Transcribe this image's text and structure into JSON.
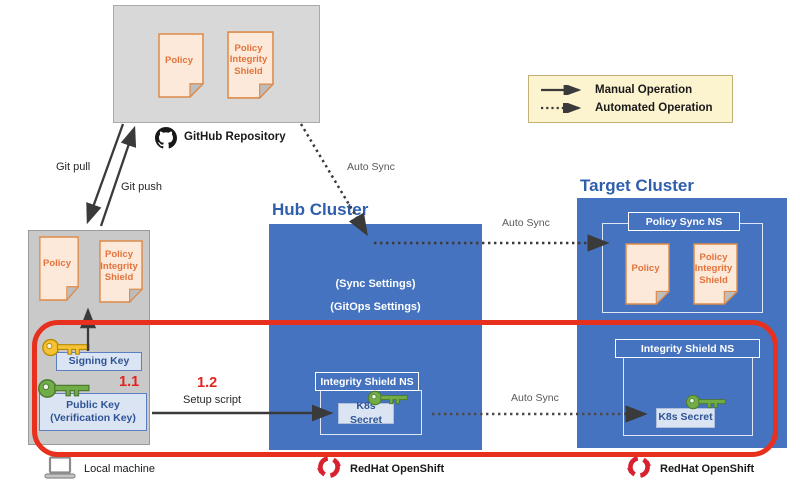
{
  "legend": {
    "manual_label": "Manual Operation",
    "automated_label": "Automated Operation"
  },
  "github_repo": {
    "caption": "GitHub Repository",
    "policy_doc": "Policy",
    "integrity_shield_doc": "Policy Integrity Shield"
  },
  "local_machine": {
    "policy_doc": "Policy",
    "integrity_shield_doc": "Policy Integrity Shield",
    "signing_key": "Signing Key",
    "public_key_line1": "Public Key",
    "public_key_line2": "(Verification Key)",
    "caption": "Local machine"
  },
  "hub_cluster": {
    "title": "Hub Cluster",
    "sync_settings": "(Sync Settings)",
    "gitops_settings": "(GitOps Settings)",
    "namespace": "Integrity Shield NS",
    "secret": "K8s Secret",
    "platform": "RedHat OpenShift"
  },
  "target_cluster": {
    "title": "Target Cluster",
    "policy_sync_namespace": "Policy Sync NS",
    "policy_doc": "Policy",
    "integrity_shield_doc": "Policy Integrity Shield",
    "integrity_namespace": "Integrity Shield NS",
    "secret": "K8s Secret",
    "platform": "RedHat OpenShift"
  },
  "labels": {
    "git_pull": "Git pull",
    "git_push": "Git push",
    "auto_sync_repo_to_hub": "Auto Sync",
    "auto_sync_hub_to_target": "Auto Sync",
    "auto_sync_secret": "Auto Sync",
    "step_1_1": "1.1",
    "step_1_2": "1.2",
    "setup_script": "Setup script"
  },
  "colors": {
    "cluster_blue": "#4673bf",
    "highlight_red": "#e8301e",
    "doc_orange": "#ed7d31",
    "legend_bg": "#fcf3cf",
    "key_yellow": "#f5c235",
    "key_green": "#70ad47",
    "redhat_red": "#d8212f"
  }
}
